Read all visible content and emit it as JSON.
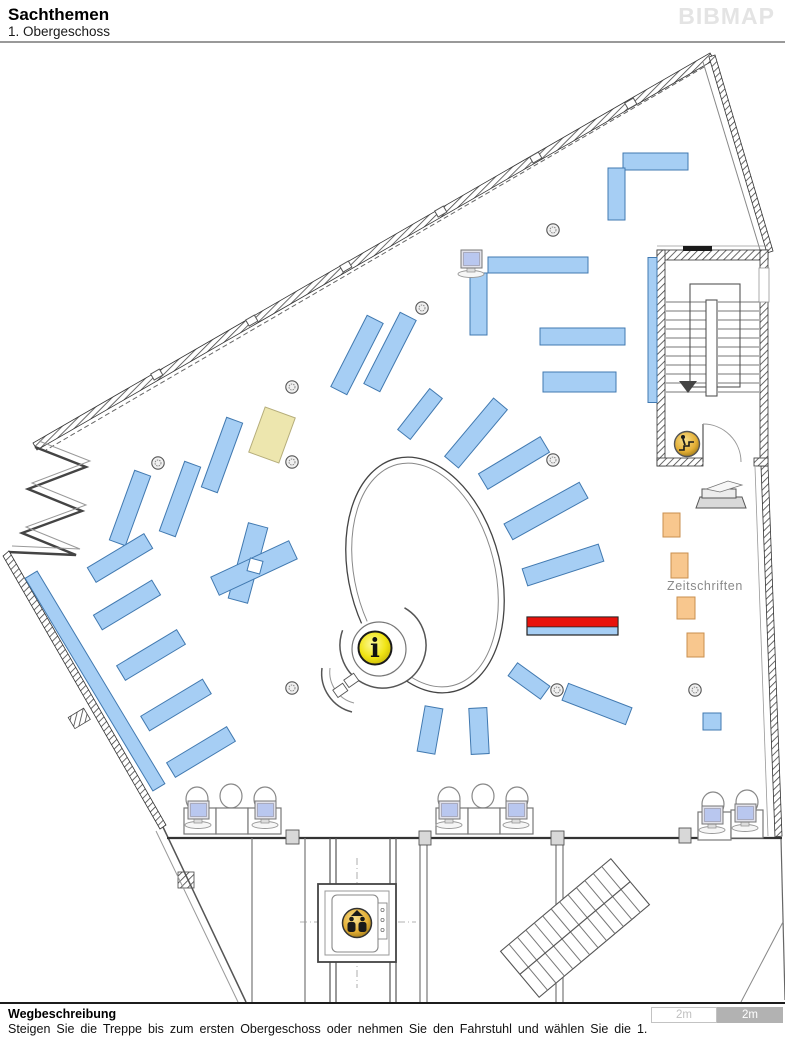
{
  "header": {
    "title": "Sachthemen",
    "subtitle": "1. Obergeschoss",
    "logo": "BIBMAP"
  },
  "footer": {
    "heading": "Wegbeschreibung",
    "description": "Steigen Sie die Treppe bis zum ersten Obergeschoss oder nehmen Sie den Fahrstuhl und wählen Sie die 1.",
    "scale": [
      {
        "label": "2m",
        "style": "light"
      },
      {
        "label": "2m",
        "style": "dark"
      }
    ]
  },
  "map": {
    "colors": {
      "shelf": "#A6CEF4",
      "shelfStroke": "#4179B0",
      "highlight": "#E8120C",
      "beige": "#EDE6AE",
      "beigeStroke": "#B5AD7A",
      "orange": "#F8C78E",
      "orangeStroke": "#C98F4F",
      "gold": "#E4AF35",
      "infoYellow": "#F0E414"
    },
    "shelves": [
      [
        655.5,
        161.5,
        65,
        17,
        0,
        "blue"
      ],
      [
        616.5,
        194,
        17,
        52,
        0,
        "blue"
      ],
      [
        652.5,
        330,
        9,
        145,
        0,
        "blue"
      ],
      [
        582.5,
        336.5,
        85,
        17,
        0,
        "blue"
      ],
      [
        579.5,
        382,
        73,
        20,
        0,
        "blue"
      ],
      [
        538,
        265,
        100,
        16,
        0,
        "blue"
      ],
      [
        478.5,
        304,
        17,
        62,
        0,
        "blue"
      ],
      [
        357,
        355,
        18,
        80,
        27,
        "blue"
      ],
      [
        390,
        352,
        18,
        80,
        27,
        "blue"
      ],
      [
        420,
        414,
        16,
        52,
        38,
        "blue"
      ],
      [
        476,
        433,
        18,
        76,
        40,
        "blue"
      ],
      [
        514,
        463,
        72,
        18,
        -31,
        "blue"
      ],
      [
        546,
        511,
        86,
        18,
        -29,
        "blue"
      ],
      [
        563,
        565,
        80,
        18,
        -18,
        "blue"
      ],
      [
        529,
        681,
        40,
        16,
        36,
        "blue"
      ],
      [
        597,
        704,
        68,
        18,
        21,
        "blue"
      ],
      [
        430,
        730,
        18,
        46,
        10,
        "blue"
      ],
      [
        479,
        731,
        18,
        46,
        -3,
        "blue"
      ],
      [
        222,
        455,
        17,
        74,
        20,
        "blue"
      ],
      [
        180,
        499,
        17,
        74,
        20,
        "blue"
      ],
      [
        130,
        508,
        17,
        74,
        20,
        "blue"
      ],
      [
        120,
        558,
        66,
        17,
        -31,
        "blue"
      ],
      [
        127,
        605,
        68,
        17,
        -31,
        "blue"
      ],
      [
        151,
        655,
        70,
        17,
        -31,
        "blue"
      ],
      [
        176,
        705,
        72,
        17,
        -31,
        "blue"
      ],
      [
        201,
        752,
        70,
        17,
        -31,
        "blue"
      ],
      [
        95,
        681,
        14,
        248,
        -31,
        "blue"
      ],
      [
        248,
        563,
        20,
        78,
        15,
        "blue"
      ],
      [
        254,
        568,
        86,
        20,
        -25,
        "blue"
      ],
      [
        255,
        566,
        13,
        13,
        15,
        "gap"
      ],
      [
        712,
        721.5,
        18,
        17,
        0,
        "blue"
      ],
      [
        272,
        435,
        32,
        48,
        20,
        "beige"
      ],
      [
        572.5,
        626,
        91,
        18,
        0,
        "highlight"
      ],
      [
        671.5,
        525,
        17,
        24,
        0,
        "orange"
      ],
      [
        679.5,
        565.5,
        17,
        25,
        0,
        "orange"
      ],
      [
        686,
        608,
        18,
        22,
        0,
        "orange"
      ],
      [
        695.5,
        645,
        17,
        24,
        0,
        "orange"
      ]
    ],
    "columns": [
      [
        553,
        230
      ],
      [
        422,
        308
      ],
      [
        158,
        463
      ],
      [
        292,
        387
      ],
      [
        292,
        462
      ],
      [
        553,
        460
      ],
      [
        292,
        688
      ],
      [
        557,
        690
      ],
      [
        695,
        690
      ]
    ],
    "computers": [
      [
        460,
        250
      ],
      [
        187,
        801
      ],
      [
        254,
        801
      ],
      [
        438,
        801
      ],
      [
        505,
        801
      ],
      [
        701,
        806
      ],
      [
        734,
        804
      ]
    ],
    "chairs": [
      [
        197,
        799
      ],
      [
        231,
        796
      ],
      [
        265,
        799
      ],
      [
        449,
        799
      ],
      [
        483,
        796
      ],
      [
        517,
        799
      ],
      [
        713,
        804
      ],
      [
        747,
        802
      ]
    ],
    "desks": [
      [
        184,
        808,
        32,
        26
      ],
      [
        216,
        808,
        32,
        26
      ],
      [
        248,
        808,
        33,
        26
      ],
      [
        436,
        808,
        32,
        26
      ],
      [
        468,
        808,
        32,
        26
      ],
      [
        500,
        808,
        33,
        26
      ],
      [
        698,
        812,
        33,
        28
      ],
      [
        731,
        810,
        32,
        28
      ]
    ],
    "wallboxes": [
      [
        286,
        830,
        13,
        14
      ],
      [
        419,
        831,
        12,
        14
      ],
      [
        551,
        831,
        13,
        14
      ],
      [
        679,
        828,
        12,
        15
      ]
    ],
    "icons": [
      {
        "name": "info-icon",
        "x": 375,
        "y": 648,
        "glyph": "i"
      },
      {
        "name": "elevator-icon",
        "x": 357,
        "y": 923
      },
      {
        "name": "stairs-down-icon",
        "x": 687,
        "y": 444
      },
      {
        "name": "copier-icon",
        "x": 702,
        "y": 481
      }
    ],
    "labels": [
      {
        "text": "Zeitschriften",
        "x": 667,
        "y": 590,
        "color": "#8A8A8A"
      }
    ]
  }
}
